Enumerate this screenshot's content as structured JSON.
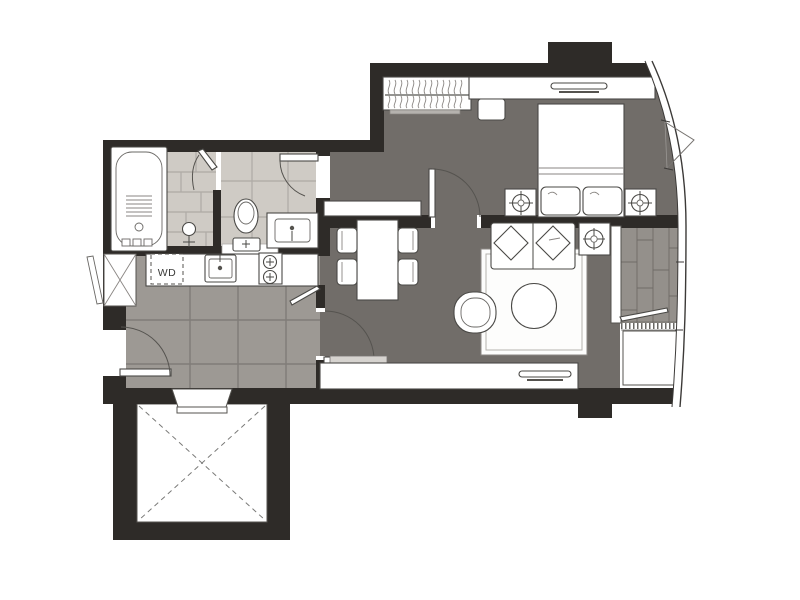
{
  "labels": {
    "washer_dryer": "WD"
  },
  "palette": {
    "wall": "#2e2b28",
    "floor_main": "#716d69",
    "floor_kitchen": "#9d9994",
    "floor_bath": "#cfcbc5",
    "floor_balcony": "#94908b",
    "background": "#ffffff",
    "outline": "#4a4946"
  },
  "fixtures": [
    "bathtub",
    "shower-tap",
    "shower-door",
    "toilet",
    "vanity-sink",
    "washer-dryer",
    "kitchen-sink",
    "stove-two-burner",
    "kitchen-counter",
    "entry-door",
    "interior-door",
    "window-casement",
    "wardrobe-hangers",
    "desk",
    "stool",
    "tv",
    "tv-console",
    "double-bed",
    "pillow",
    "nightstand",
    "table-lamp",
    "sofa",
    "throw-pillow",
    "rug",
    "coffee-table",
    "armchair",
    "side-table",
    "tv-bench",
    "shelf",
    "dining-table",
    "dining-chair",
    "balcony-deck",
    "balcony-door",
    "ac-unit",
    "void-shaft",
    "curved-window-wall"
  ]
}
